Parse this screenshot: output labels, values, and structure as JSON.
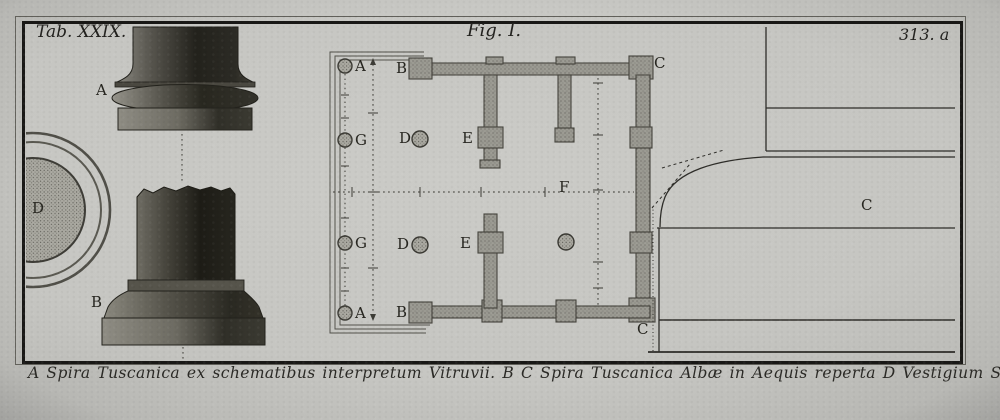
{
  "plate": {
    "tab_label": "Tab. XXIX.",
    "fig_label": "Fig. I.",
    "plate_number": "313. a",
    "caption": "A Spira Tuscanica ex schematibus interpretum Vitruvii. B C Spira Tuscanica Albæ in Aequis reperta D Vestigium Spiræ Albanæ."
  },
  "labels": {
    "column_a": "A",
    "column_b": "B",
    "vestigium_d": "D",
    "plan_top_a": "A",
    "plan_top_b": "B",
    "plan_top_c": "C",
    "plan_g_upper": "G",
    "plan_d_upper": "D",
    "plan_e_upper": "E",
    "plan_center_f": "F",
    "plan_g_lower": "G",
    "plan_d_lower": "D",
    "plan_e_lower": "E",
    "plan_bottom_a": "A",
    "plan_bottom_b": "B",
    "plan_bottom_c": "C",
    "profile_c": "C"
  },
  "colors": {
    "paper": "#c9c9c5",
    "frame_ink": "#191816",
    "line_ink": "#2e2d29",
    "wall_gray": "#98978f",
    "shaft_dark": "#23221c"
  }
}
